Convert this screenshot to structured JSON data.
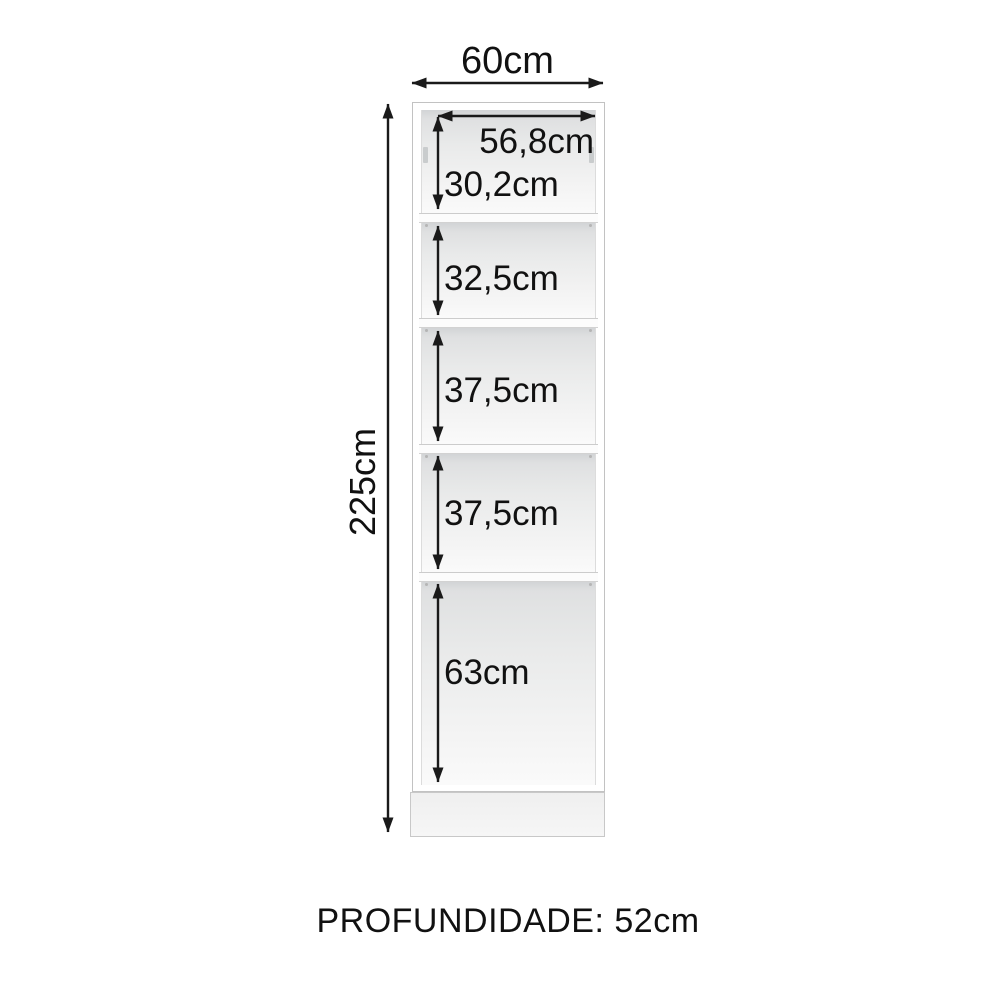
{
  "cabinet": {
    "width_label": "60cm",
    "height_label": "225cm",
    "inner_width_label": "56,8cm",
    "sections": [
      {
        "label": "30,2cm"
      },
      {
        "label": "32,5cm"
      },
      {
        "label": "37,5cm"
      },
      {
        "label": "37,5cm"
      },
      {
        "label": "63cm"
      }
    ],
    "depth_label": "PROFUNDIDADE: 52cm"
  },
  "colors": {
    "dimension_text": "#111111",
    "arrow": "#1a1a1a",
    "cabinet_outline": "#c2c2c2",
    "page_bg": "#ffffff"
  }
}
